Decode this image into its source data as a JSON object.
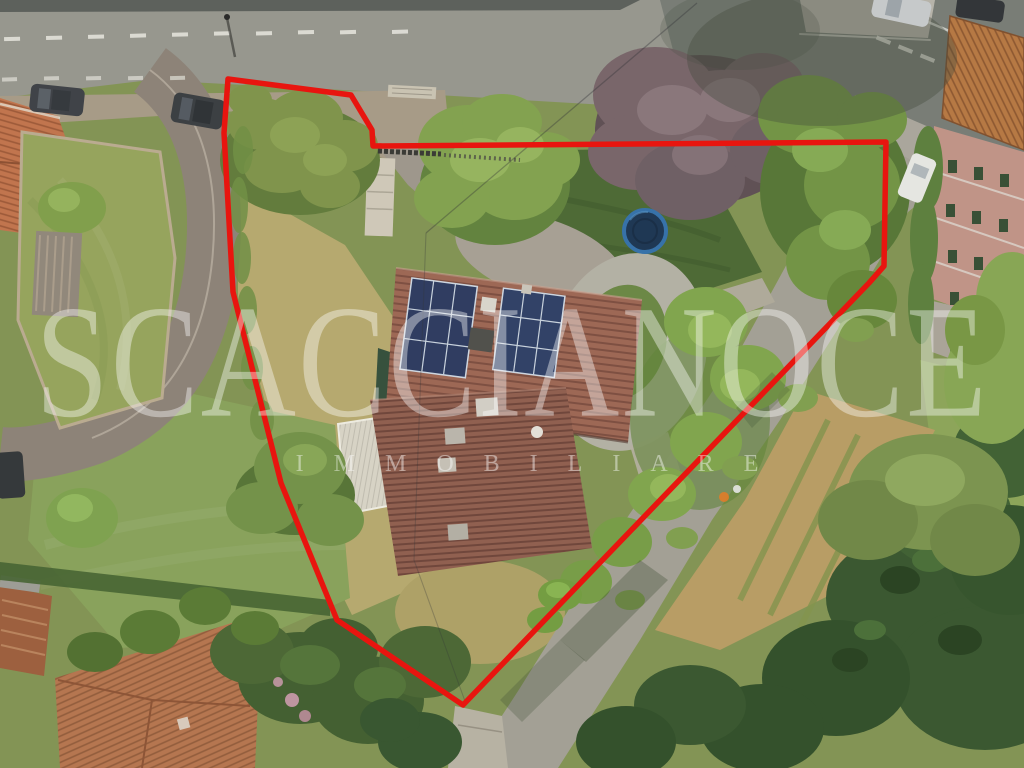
{
  "photo": {
    "kind": "aerial-drone-photograph",
    "subject": "hillside property with house, solar-panel roof, garden, pool-trampoline and surrounding roads, outlined in red"
  },
  "overlay": {
    "boundary_color": "#e8150f",
    "watermark_line1": "SCACCIANOCE",
    "watermark_line2": "IMMOBILIARE",
    "watermark_color": "#ffffff"
  }
}
